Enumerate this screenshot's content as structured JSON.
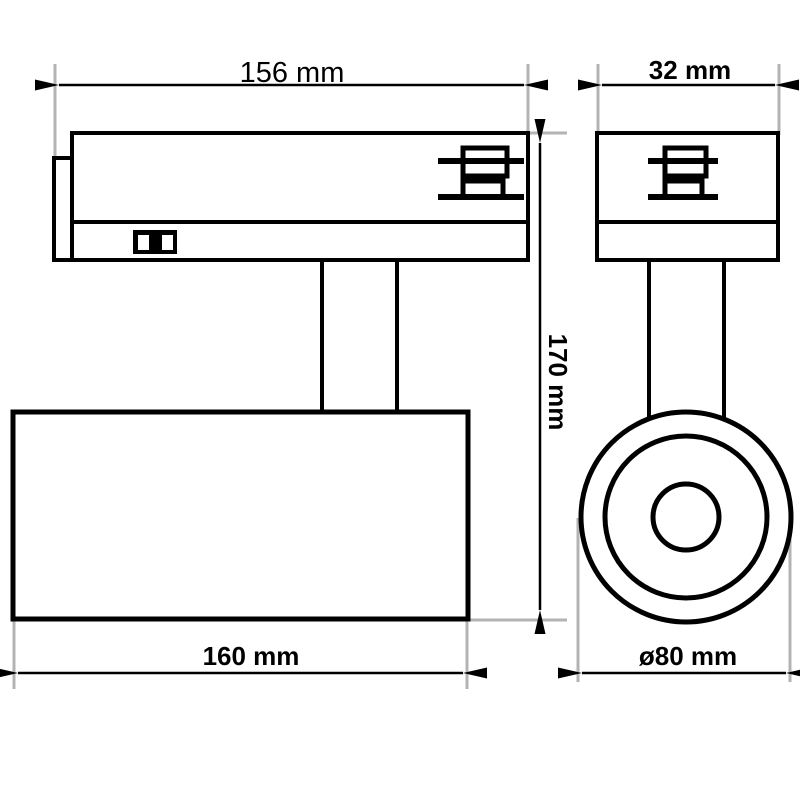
{
  "colors": {
    "outline": "#000000",
    "extension_line": "#b3b3b3",
    "background": "#ffffff"
  },
  "views": {
    "side": {
      "label_width_top": "156 mm",
      "label_height": "170 mm",
      "label_length_bottom": "160 mm"
    },
    "front": {
      "label_width_top": "32 mm",
      "label_diameter": "ø80 mm"
    }
  },
  "icons": {
    "contacts": "track-contact-icon",
    "switch": "power-switch-icon"
  }
}
